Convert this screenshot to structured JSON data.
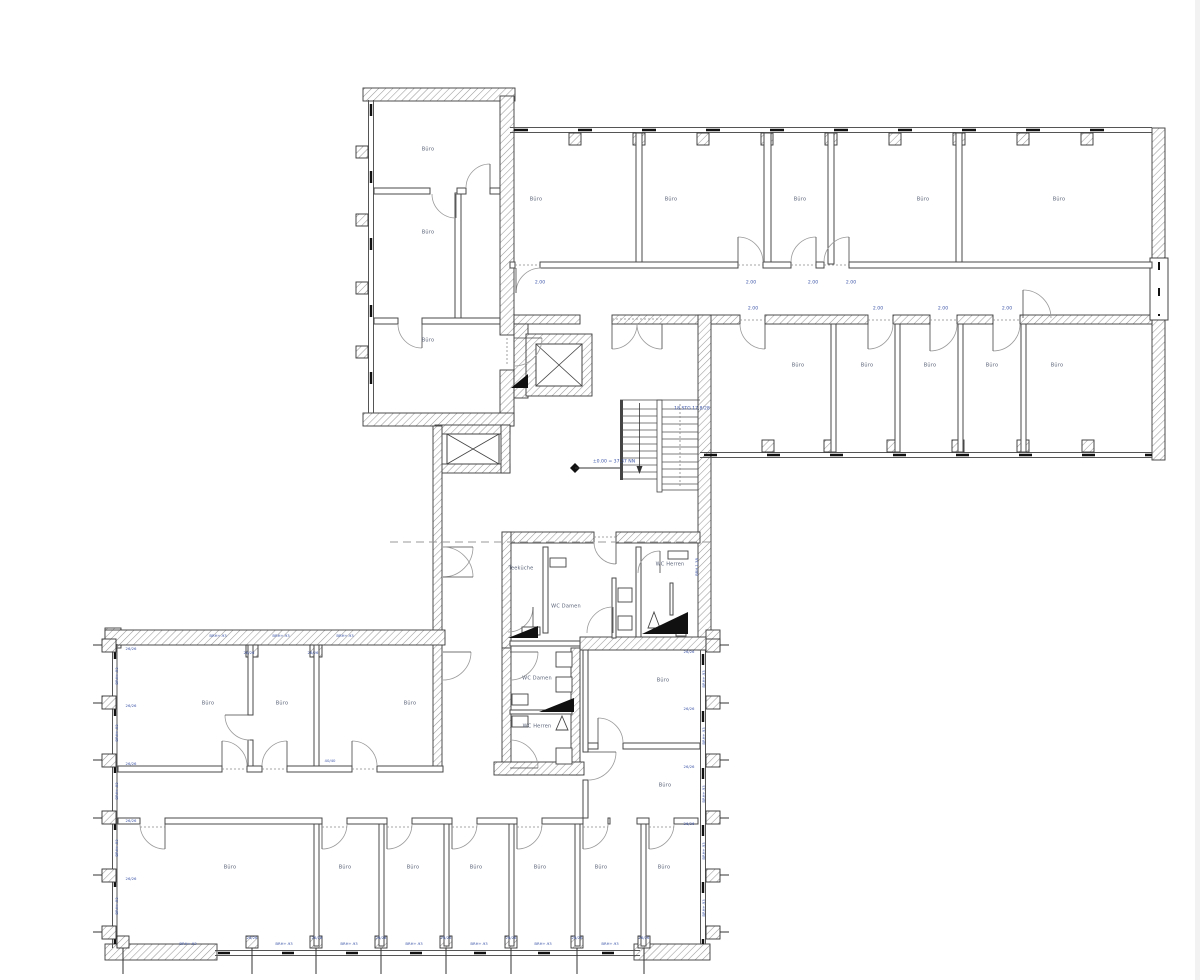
{
  "drawing": {
    "language": "de",
    "colors": {
      "wall_outline": "#3b3b3b",
      "hatch": "#9a9a9a",
      "room_label": "#5a6378",
      "dim_label": "#3d56a8",
      "symbol_black": "#111111"
    }
  },
  "labels": [
    {
      "name": "room-label",
      "cls": "room",
      "t": "Büro",
      "x": 428,
      "y": 150
    },
    {
      "name": "room-label",
      "cls": "room",
      "t": "Büro",
      "x": 428,
      "y": 233
    },
    {
      "name": "room-label",
      "cls": "room",
      "t": "Büro",
      "x": 428,
      "y": 341
    },
    {
      "name": "room-label",
      "cls": "room",
      "t": "Büro",
      "x": 536,
      "y": 200
    },
    {
      "name": "room-label",
      "cls": "room",
      "t": "Büro",
      "x": 671,
      "y": 200
    },
    {
      "name": "room-label",
      "cls": "room",
      "t": "Büro",
      "x": 800,
      "y": 200
    },
    {
      "name": "room-label",
      "cls": "room",
      "t": "Büro",
      "x": 923,
      "y": 200
    },
    {
      "name": "room-label",
      "cls": "room",
      "t": "Büro",
      "x": 1059,
      "y": 200
    },
    {
      "name": "room-label",
      "cls": "room",
      "t": "Büro",
      "x": 798,
      "y": 366
    },
    {
      "name": "room-label",
      "cls": "room",
      "t": "Büro",
      "x": 867,
      "y": 366
    },
    {
      "name": "room-label",
      "cls": "room",
      "t": "Büro",
      "x": 930,
      "y": 366
    },
    {
      "name": "room-label",
      "cls": "room",
      "t": "Büro",
      "x": 992,
      "y": 366
    },
    {
      "name": "room-label",
      "cls": "room",
      "t": "Büro",
      "x": 1057,
      "y": 366
    },
    {
      "name": "room-label",
      "cls": "room",
      "t": "Teeküche",
      "x": 521,
      "y": 569
    },
    {
      "name": "room-label",
      "cls": "room",
      "t": "WC Damen",
      "x": 566,
      "y": 607
    },
    {
      "name": "room-label",
      "cls": "room",
      "t": "WC Herren",
      "x": 670,
      "y": 565
    },
    {
      "name": "room-label",
      "cls": "room",
      "t": "WC Damen",
      "x": 537,
      "y": 679
    },
    {
      "name": "room-label",
      "cls": "room",
      "t": "WC Herren",
      "x": 537,
      "y": 727
    },
    {
      "name": "room-label",
      "cls": "room",
      "t": "Büro",
      "x": 663,
      "y": 681
    },
    {
      "name": "room-label",
      "cls": "room",
      "t": "Büro",
      "x": 665,
      "y": 786
    },
    {
      "name": "room-label",
      "cls": "room",
      "t": "Büro",
      "x": 208,
      "y": 704
    },
    {
      "name": "room-label",
      "cls": "room",
      "t": "Büro",
      "x": 282,
      "y": 704
    },
    {
      "name": "room-label",
      "cls": "room",
      "t": "Büro",
      "x": 410,
      "y": 704
    },
    {
      "name": "room-label",
      "cls": "room",
      "t": "Büro",
      "x": 230,
      "y": 868
    },
    {
      "name": "room-label",
      "cls": "room",
      "t": "Büro",
      "x": 345,
      "y": 868
    },
    {
      "name": "room-label",
      "cls": "room",
      "t": "Büro",
      "x": 413,
      "y": 868
    },
    {
      "name": "room-label",
      "cls": "room",
      "t": "Büro",
      "x": 476,
      "y": 868
    },
    {
      "name": "room-label",
      "cls": "room",
      "t": "Büro",
      "x": 540,
      "y": 868
    },
    {
      "name": "room-label",
      "cls": "room",
      "t": "Büro",
      "x": 601,
      "y": 868
    },
    {
      "name": "room-label",
      "cls": "room",
      "t": "Büro",
      "x": 664,
      "y": 868
    },
    {
      "name": "dim-label",
      "cls": "dim",
      "t": "2.00",
      "x": 540,
      "y": 284
    },
    {
      "name": "dim-label",
      "cls": "dim",
      "t": "2.00",
      "x": 751,
      "y": 284
    },
    {
      "name": "dim-label",
      "cls": "dim",
      "t": "2.00",
      "x": 813,
      "y": 284
    },
    {
      "name": "dim-label",
      "cls": "dim",
      "t": "2.00",
      "x": 851,
      "y": 284
    },
    {
      "name": "dim-label",
      "cls": "dim",
      "t": "2.00",
      "x": 753,
      "y": 310
    },
    {
      "name": "dim-label",
      "cls": "dim",
      "t": "2.00",
      "x": 878,
      "y": 310
    },
    {
      "name": "dim-label",
      "cls": "dim",
      "t": "2.00",
      "x": 943,
      "y": 310
    },
    {
      "name": "dim-label",
      "cls": "dim",
      "t": "2.00",
      "x": 1007,
      "y": 310
    },
    {
      "name": "stair-label",
      "cls": "dim",
      "t": "18 STG 17,8/28",
      "x": 692,
      "y": 410
    },
    {
      "name": "level-label",
      "cls": "dim",
      "t": "±0.00 = 37.37 NN",
      "x": 614,
      "y": 463
    },
    {
      "name": "parapet-label",
      "cls": "tiny rot",
      "t": "BRH 1.38",
      "x": 697,
      "y": 567
    },
    {
      "name": "parapet-label",
      "cls": "tiny",
      "t": "BRH+.93",
      "x": 218,
      "y": 636
    },
    {
      "name": "parapet-label",
      "cls": "tiny",
      "t": "BRH+.93",
      "x": 281,
      "y": 636
    },
    {
      "name": "parapet-label",
      "cls": "tiny",
      "t": "BRH+.93",
      "x": 345,
      "y": 636
    },
    {
      "name": "column-label",
      "cls": "tiny",
      "t": "26/26",
      "x": 249,
      "y": 653
    },
    {
      "name": "column-label",
      "cls": "tiny",
      "t": "26/26",
      "x": 313,
      "y": 653
    },
    {
      "name": "column-label",
      "cls": "tiny",
      "t": "40/40",
      "x": 330,
      "y": 761
    },
    {
      "name": "parapet-label",
      "cls": "tiny",
      "t": "BRH+.93",
      "x": 188,
      "y": 944
    },
    {
      "name": "parapet-label",
      "cls": "tiny",
      "t": "BRH+.93",
      "x": 284,
      "y": 944
    },
    {
      "name": "parapet-label",
      "cls": "tiny",
      "t": "BRH+.93",
      "x": 349,
      "y": 944
    },
    {
      "name": "parapet-label",
      "cls": "tiny",
      "t": "BRH+.93",
      "x": 414,
      "y": 944
    },
    {
      "name": "parapet-label",
      "cls": "tiny",
      "t": "BRH+.93",
      "x": 479,
      "y": 944
    },
    {
      "name": "parapet-label",
      "cls": "tiny",
      "t": "BRH+.93",
      "x": 543,
      "y": 944
    },
    {
      "name": "parapet-label",
      "cls": "tiny",
      "t": "BRH+.93",
      "x": 610,
      "y": 944
    },
    {
      "name": "column-label",
      "cls": "tiny",
      "t": "26/26",
      "x": 252,
      "y": 938
    },
    {
      "name": "column-label",
      "cls": "tiny",
      "t": "26/26",
      "x": 317,
      "y": 938
    },
    {
      "name": "column-label",
      "cls": "tiny",
      "t": "26/26",
      "x": 381,
      "y": 938
    },
    {
      "name": "column-label",
      "cls": "tiny",
      "t": "26/26",
      "x": 446,
      "y": 938
    },
    {
      "name": "column-label",
      "cls": "tiny",
      "t": "26/26",
      "x": 511,
      "y": 938
    },
    {
      "name": "column-label",
      "cls": "tiny",
      "t": "26/26",
      "x": 577,
      "y": 938
    },
    {
      "name": "column-label",
      "cls": "tiny",
      "t": "26/26",
      "x": 644,
      "y": 938
    },
    {
      "name": "parapet-label",
      "cls": "tiny rot",
      "t": "BRH+.93",
      "x": 117,
      "y": 676
    },
    {
      "name": "parapet-label",
      "cls": "tiny rot",
      "t": "BRH+.93",
      "x": 117,
      "y": 733
    },
    {
      "name": "parapet-label",
      "cls": "tiny rot",
      "t": "BRH+.93",
      "x": 117,
      "y": 791
    },
    {
      "name": "parapet-label",
      "cls": "tiny rot",
      "t": "BRH+.93",
      "x": 117,
      "y": 848
    },
    {
      "name": "parapet-label",
      "cls": "tiny rot",
      "t": "BRH+.93",
      "x": 117,
      "y": 906
    },
    {
      "name": "column-label",
      "cls": "tiny",
      "t": "26/26",
      "x": 131,
      "y": 649
    },
    {
      "name": "column-label",
      "cls": "tiny",
      "t": "26/26",
      "x": 131,
      "y": 706
    },
    {
      "name": "column-label",
      "cls": "tiny",
      "t": "26/26",
      "x": 131,
      "y": 764
    },
    {
      "name": "column-label",
      "cls": "tiny",
      "t": "26/26",
      "x": 131,
      "y": 821
    },
    {
      "name": "column-label",
      "cls": "tiny",
      "t": "26/26",
      "x": 131,
      "y": 879
    },
    {
      "name": "parapet-label",
      "cls": "tiny rot",
      "t": "BRH+.93",
      "x": 704,
      "y": 679
    },
    {
      "name": "parapet-label",
      "cls": "tiny rot",
      "t": "BRH+.93",
      "x": 704,
      "y": 736
    },
    {
      "name": "parapet-label",
      "cls": "tiny rot",
      "t": "BRH+.93",
      "x": 704,
      "y": 794
    },
    {
      "name": "parapet-label",
      "cls": "tiny rot",
      "t": "BRH+.93",
      "x": 704,
      "y": 851
    },
    {
      "name": "parapet-label",
      "cls": "tiny rot",
      "t": "BRH+.93",
      "x": 704,
      "y": 908
    },
    {
      "name": "column-label",
      "cls": "tiny",
      "t": "26/26",
      "x": 689,
      "y": 652
    },
    {
      "name": "column-label",
      "cls": "tiny",
      "t": "26/26",
      "x": 689,
      "y": 709
    },
    {
      "name": "column-label",
      "cls": "tiny",
      "t": "26/26",
      "x": 689,
      "y": 767
    },
    {
      "name": "column-label",
      "cls": "tiny",
      "t": "26/26",
      "x": 689,
      "y": 824
    }
  ]
}
